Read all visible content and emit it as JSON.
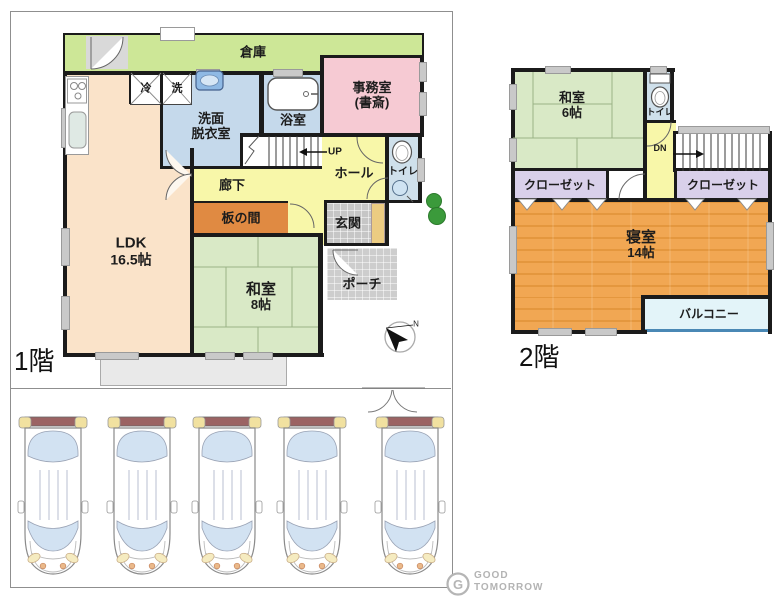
{
  "floor1": {
    "title": "1階",
    "rooms": {
      "storage": "倉庫",
      "office_line1": "事務室",
      "office_line2": "(書斎)",
      "fridge": "冷",
      "washer": "洗",
      "washroom_line1": "洗面",
      "washroom_line2": "脱衣室",
      "bathroom": "浴室",
      "stairs_up": "UP",
      "hall": "ホール",
      "toilet": "トイレ",
      "corridor": "廊下",
      "wood_board_room": "板の間",
      "entrance": "玄関",
      "porch": "ポーチ",
      "ldk_line1": "LDK",
      "ldk_line2": "16.5帖",
      "japanese_room_line1": "和室",
      "japanese_room_line2": "8帖"
    }
  },
  "floor2": {
    "title": "2階",
    "rooms": {
      "japanese_room_line1": "和室",
      "japanese_room_line2": "6帖",
      "toilet": "トイレ",
      "stairs_down": "DN",
      "closet_left": "クローゼット",
      "closet_right": "クローゼット",
      "bedroom_line1": "寝室",
      "bedroom_line2": "14帖",
      "balcony": "バルコニー"
    }
  },
  "compass": {
    "north_label": "N"
  },
  "logo": {
    "mark": "G",
    "line1": "GOOD",
    "line2": "TOMORROW"
  },
  "colors": {
    "wall": "#1b1b1b",
    "ldk": "#fae3c9",
    "tatami": "#d9e9c6",
    "corridor_yellow": "#f8f7a9",
    "water_rooms_blue": "#c5d9eb",
    "office_pink": "#f6cad3",
    "storage_green": "#cde797",
    "wood_board_orange": "#e08a42",
    "entrance_gray": "#c6c6c6",
    "closet_purple": "#d9d0ea",
    "bedroom_wood": "#f0a751",
    "balcony_cyan": "#e3f4f9",
    "balcony_edge": "#4a88b5",
    "door_tan": "#eccc82",
    "car_window": "#d2e2f2",
    "car_spoiler": "#9b6363"
  }
}
